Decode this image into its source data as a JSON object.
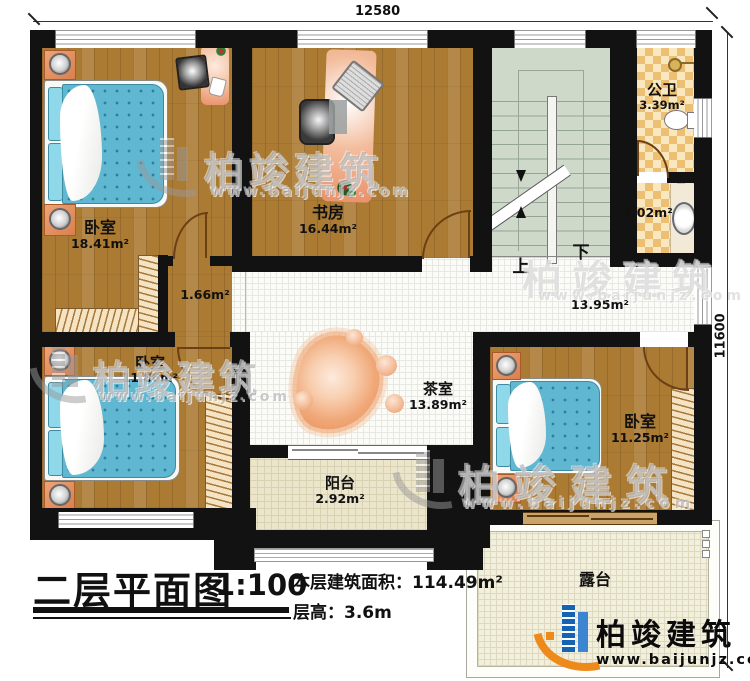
{
  "plan": {
    "dimensions": {
      "top": "12580",
      "right": "11600"
    },
    "stairs": {
      "up": "上",
      "down": "下"
    },
    "rooms": [
      {
        "name": "卧室",
        "area": "18.41m²"
      },
      {
        "name": "书房",
        "area": "16.44m²"
      },
      {
        "name": "公卫",
        "area": "3.39m²"
      },
      {
        "name": "",
        "area": "2.02m²"
      },
      {
        "name": "",
        "area": "1.66m²"
      },
      {
        "name": "",
        "area": "13.95m²"
      },
      {
        "name": "茶室",
        "area": "13.89m²"
      },
      {
        "name": "卧室",
        "area": "11.86m²"
      },
      {
        "name": "卧室",
        "area": "11.25m²"
      },
      {
        "name": "阳台",
        "area": "2.92m²"
      },
      {
        "name": "露台",
        "area": ""
      }
    ]
  },
  "title_block": {
    "title": "二层平面图",
    "scale": "1:100",
    "area_label": "本层建筑面积：",
    "area_value": "114.49m²",
    "height_label": "层高：",
    "height_value": "3.6m"
  },
  "brand": {
    "name": "柏竣建筑",
    "url": "www.baijunjz.com",
    "blue": "#1563b5",
    "orange": "#ee8a1c"
  },
  "watermark": {
    "name": "柏竣建筑",
    "url": "www.baijunjz.com"
  }
}
